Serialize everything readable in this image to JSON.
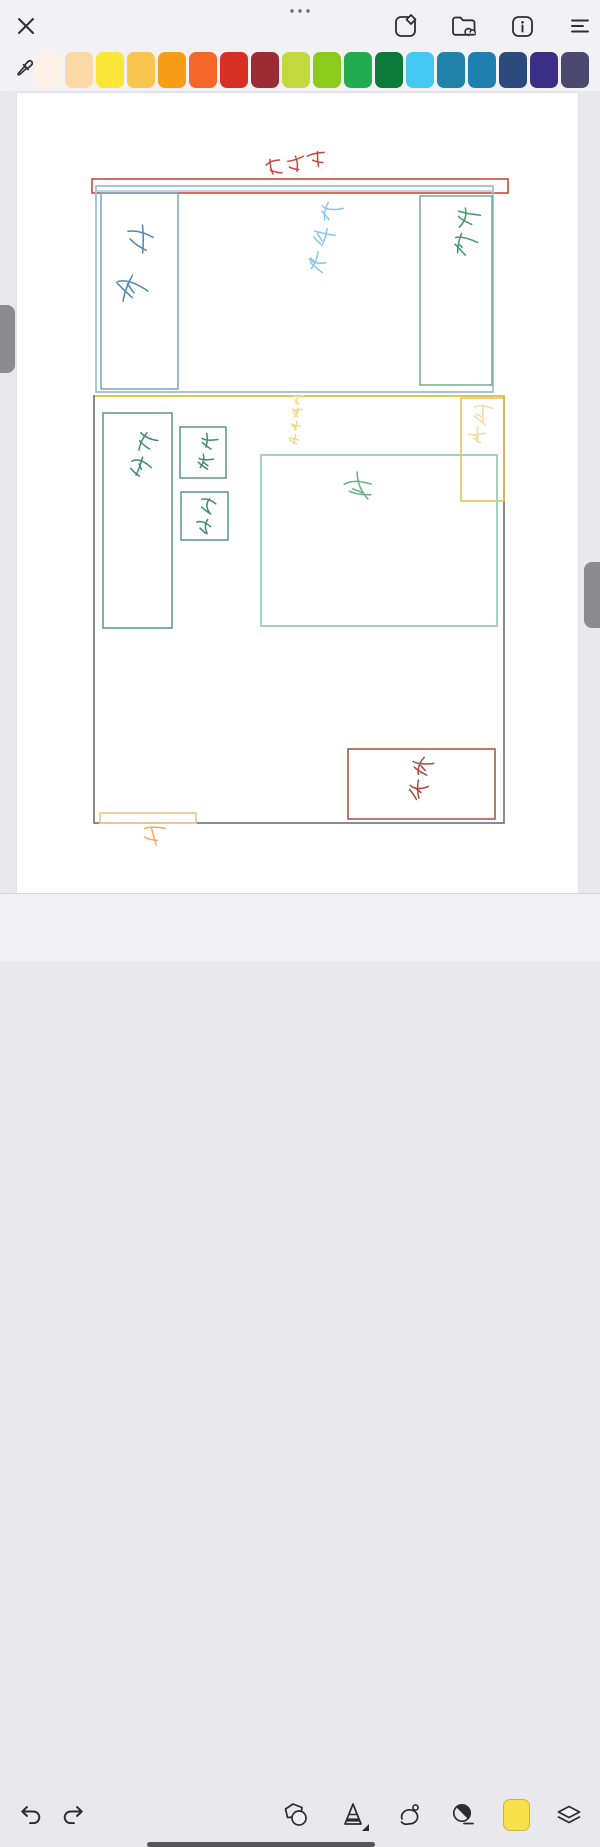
{
  "top_toolbar": {
    "close": "close",
    "more": "more-options",
    "right_icons": [
      "share-note-icon",
      "folder-cloud-icon",
      "info-icon",
      "menu-lines-icon"
    ]
  },
  "palette": {
    "tool": "eyedropper",
    "colors": [
      "#fdf1e7",
      "#fbd9a6",
      "#fbe539",
      "#f8c54d",
      "#f79d16",
      "#f4662a",
      "#d93026",
      "#9c2b33",
      "#c2d93e",
      "#8ccb1d",
      "#22ab4f",
      "#0d7a3a",
      "#45c8f1",
      "#2082a9",
      "#1f7fae",
      "#2c4a7c",
      "#3a2e85",
      "#4c4870"
    ]
  },
  "bottom_toolbar": {
    "tools": [
      "undo",
      "redo",
      "shapes",
      "pen",
      "lasso",
      "eraser",
      "current-color",
      "layers"
    ],
    "current_color": "#f6e14b",
    "active_tool_has_options": true
  },
  "canvas_drawing": {
    "page_color": "#ffffff",
    "rects": [
      {
        "name": "balcony-wall",
        "x": 92,
        "y": 179,
        "w": 416,
        "h": 14,
        "color": "#c94a3b",
        "sw": 1.6
      },
      {
        "name": "top-room-outline",
        "x": 96,
        "y": 186,
        "w": 397,
        "h": 206,
        "color": "#9cc0cf",
        "sw": 1.8
      },
      {
        "name": "sink-cabinet",
        "x": 101,
        "y": 193,
        "w": 77,
        "h": 196,
        "color": "#7ba6bd",
        "sw": 1.5
      },
      {
        "name": "top-right-cabinet",
        "x": 420,
        "y": 196,
        "w": 72,
        "h": 189,
        "color": "#79ab8f",
        "sw": 1.5
      },
      {
        "name": "lower-room-outline",
        "x": 94,
        "y": 396,
        "w": 410,
        "h": 427,
        "color": "#74787b",
        "sw": 1.7
      },
      {
        "name": "ac-unit-box",
        "x": 461,
        "y": 398,
        "w": 43,
        "h": 103,
        "color": "#f0b84e",
        "sw": 1.5
      },
      {
        "name": "desk-box",
        "x": 103,
        "y": 413,
        "w": 69,
        "h": 215,
        "color": "#5d9488",
        "sw": 1.5
      },
      {
        "name": "chair-box-1",
        "x": 180,
        "y": 427,
        "w": 46,
        "h": 51,
        "color": "#5d9488",
        "sw": 1.5
      },
      {
        "name": "chair-box-2",
        "x": 181,
        "y": 492,
        "w": 47,
        "h": 48,
        "color": "#5d9488",
        "sw": 1.5
      },
      {
        "name": "bed-box",
        "x": 261,
        "y": 455,
        "w": 236,
        "h": 171,
        "color": "#a3d4ba",
        "sw": 2
      },
      {
        "name": "wardrobe-box",
        "x": 348,
        "y": 749,
        "w": 147,
        "h": 70,
        "color": "#a64a40",
        "sw": 1.5
      },
      {
        "name": "door-sill",
        "x": 100,
        "y": 813,
        "w": 96,
        "h": 10,
        "color": "#f2c79d",
        "sw": 1.8
      }
    ],
    "lines": [
      {
        "name": "wall-inner-line",
        "x1": 97,
        "y1": 191,
        "x2": 492,
        "y2": 191,
        "color": "#9cc0cf",
        "sw": 1.3
      },
      {
        "name": "yellow-divider",
        "x1": 95,
        "y1": 396,
        "x2": 505,
        "y2": 396,
        "color": "#eccb4e",
        "sw": 1.8
      }
    ],
    "annotations": [
      {
        "label": "阳台门",
        "name": "balcony-note",
        "x": 263,
        "y": 148,
        "w": 66,
        "h": 32,
        "color": "#c4473c",
        "glyphs": 3,
        "vertical": false,
        "tilt": -10
      },
      {
        "label": "水池",
        "name": "sink-note",
        "x": 114,
        "y": 214,
        "w": 40,
        "h": 96,
        "color": "#4f86b2",
        "glyphs": 2,
        "vertical": true,
        "tilt": 12
      },
      {
        "label": "302",
        "name": "room-number-note",
        "x": 300,
        "y": 196,
        "w": 46,
        "h": 80,
        "color": "#86c6e8",
        "glyphs": 3,
        "vertical": true,
        "tilt": 14
      },
      {
        "label": "柜子",
        "name": "cabinet-note",
        "x": 446,
        "y": 202,
        "w": 38,
        "h": 58,
        "color": "#41996a",
        "glyphs": 2,
        "vertical": true,
        "tilt": 8
      },
      {
        "label": "桌子",
        "name": "desk-note",
        "x": 118,
        "y": 426,
        "w": 52,
        "h": 56,
        "color": "#3f8a76",
        "glyphs": 2,
        "vertical": true,
        "tilt": 14
      },
      {
        "label": "椅子",
        "name": "chair-note-1",
        "x": 191,
        "y": 432,
        "w": 30,
        "h": 40,
        "color": "#3f8a76",
        "glyphs": 2,
        "vertical": true,
        "tilt": 8
      },
      {
        "label": "椅子",
        "name": "chair-note-2",
        "x": 192,
        "y": 495,
        "w": 30,
        "h": 42,
        "color": "#3f8a76",
        "glyphs": 2,
        "vertical": true,
        "tilt": 8
      },
      {
        "label": "床",
        "name": "bed-note",
        "x": 336,
        "y": 466,
        "w": 52,
        "h": 42,
        "color": "#63b089",
        "glyphs": 1,
        "vertical": false,
        "tilt": -12
      },
      {
        "label": "玻璃推拉门",
        "name": "glass-door-note",
        "x": 274,
        "y": 392,
        "w": 44,
        "h": 54,
        "color": "#f2dd84",
        "glyphs": 4,
        "vertical": true,
        "tilt": 6
      },
      {
        "label": "空调",
        "name": "ac-note",
        "x": 466,
        "y": 402,
        "w": 26,
        "h": 46,
        "color": "#f3daa6",
        "glyphs": 2,
        "vertical": true,
        "tilt": 6
      },
      {
        "label": "衣柜",
        "name": "wardrobe-note",
        "x": 400,
        "y": 752,
        "w": 38,
        "h": 52,
        "color": "#a64a40",
        "glyphs": 2,
        "vertical": true,
        "tilt": 10
      },
      {
        "label": "门",
        "name": "door-note",
        "x": 138,
        "y": 822,
        "w": 30,
        "h": 26,
        "color": "#f1a966",
        "glyphs": 1,
        "vertical": false,
        "tilt": -6
      }
    ]
  }
}
